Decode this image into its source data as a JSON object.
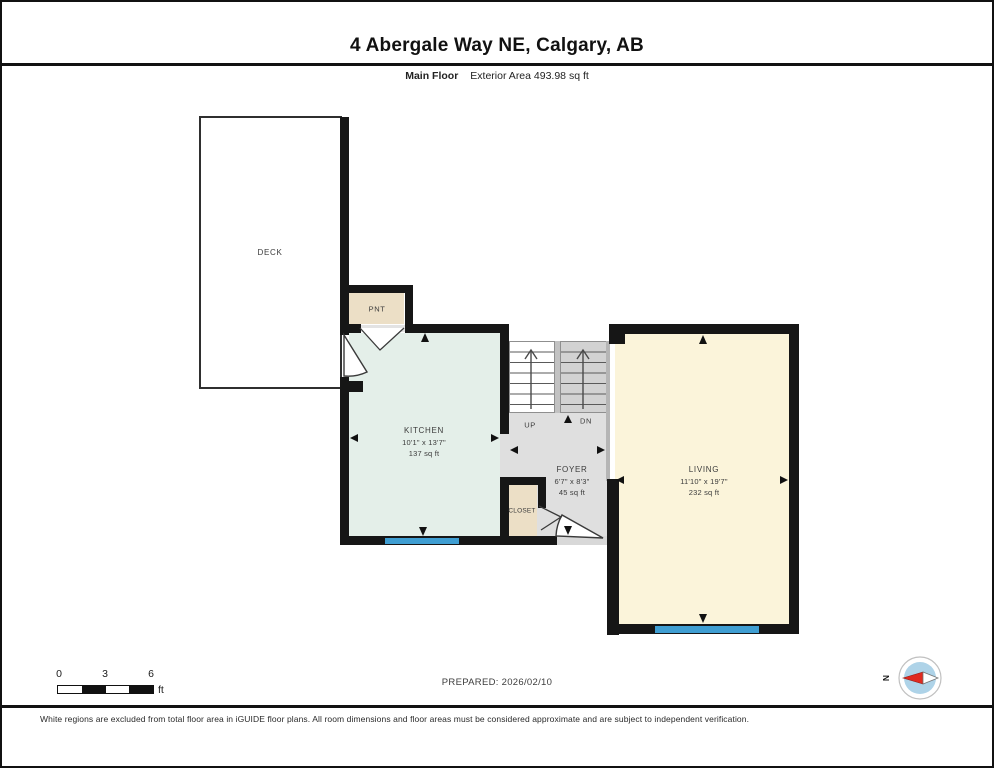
{
  "header": {
    "title": "4 Abergale Way NE, Calgary, AB",
    "floor_label": "Main Floor",
    "area_label": "Exterior Area 493.98 sq ft"
  },
  "rooms": {
    "deck": {
      "name": "DECK"
    },
    "pantry": {
      "name": "PNT"
    },
    "kitchen": {
      "name": "KITCHEN",
      "dimensions": "10'1\" x 13'7\"",
      "area": "137 sq ft"
    },
    "foyer": {
      "name": "FOYER",
      "dimensions": "6'7\" x 8'3\"",
      "area": "45 sq ft"
    },
    "living": {
      "name": "LIVING",
      "dimensions": "11'10\" x 19'7\"",
      "area": "232 sq ft"
    },
    "closet": {
      "name": "CLOSET"
    },
    "stairs": {
      "up_label": "UP",
      "down_label": "DN"
    }
  },
  "footer": {
    "scale_bar": {
      "ticks": [
        "0",
        "3",
        "6"
      ],
      "unit": "ft"
    },
    "prepared_label": "PREPARED: 2026/02/10",
    "compass": {
      "north_label": "N"
    },
    "disclaimer": "White regions are excluded from total floor area in iGUIDE floor plans. All room dimensions and floor areas must be considered approximate and are subject to independent verification."
  },
  "colors": {
    "wall": "#161616",
    "kitchen_fill": "#e4efe9",
    "living_fill": "#fbf4da",
    "pantry_fill": "#ecdfc6",
    "closet_fill": "#ecdfc6",
    "foyer_fill": "#dfdfdf",
    "stairs_down_fill": "#d2d2d2",
    "window_blue": "#3f9ed2",
    "compass_disk": "#aed3e8",
    "compass_needle_red": "#e02a20"
  }
}
